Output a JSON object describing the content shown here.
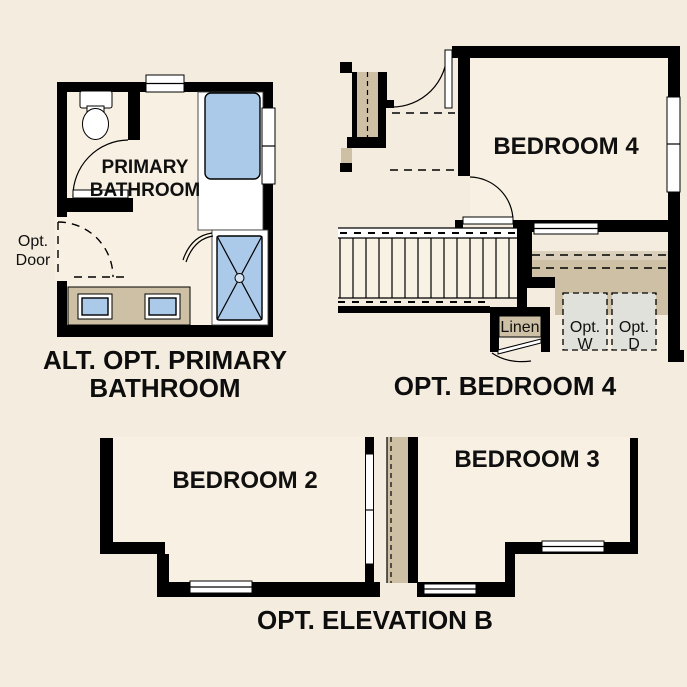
{
  "colors": {
    "background": "#f4ecdf",
    "room_fill": "#f8f1e3",
    "wall": "#000000",
    "fixture_blue": "#abc9e8",
    "tan": "#cdc0a4",
    "tan_light": "#d9cfba",
    "laundry_box": "#dfe1da"
  },
  "bathroom_plan": {
    "room_label_line1": "PRIMARY",
    "room_label_line2": "BATHROOM",
    "opt_door_line1": "Opt.",
    "opt_door_line2": "Door",
    "caption_line1": "ALT. OPT. PRIMARY",
    "caption_line2": "BATHROOM"
  },
  "bedroom4_plan": {
    "room_label": "BEDROOM 4",
    "linen_label": "Linen",
    "washer_line1": "Opt.",
    "washer_line2": "W",
    "dryer_line1": "Opt.",
    "dryer_line2": "D",
    "caption": "OPT. BEDROOM 4"
  },
  "elevation_plan": {
    "bedroom2_label": "BEDROOM 2",
    "bedroom3_label": "BEDROOM 3",
    "caption": "OPT. ELEVATION B"
  }
}
